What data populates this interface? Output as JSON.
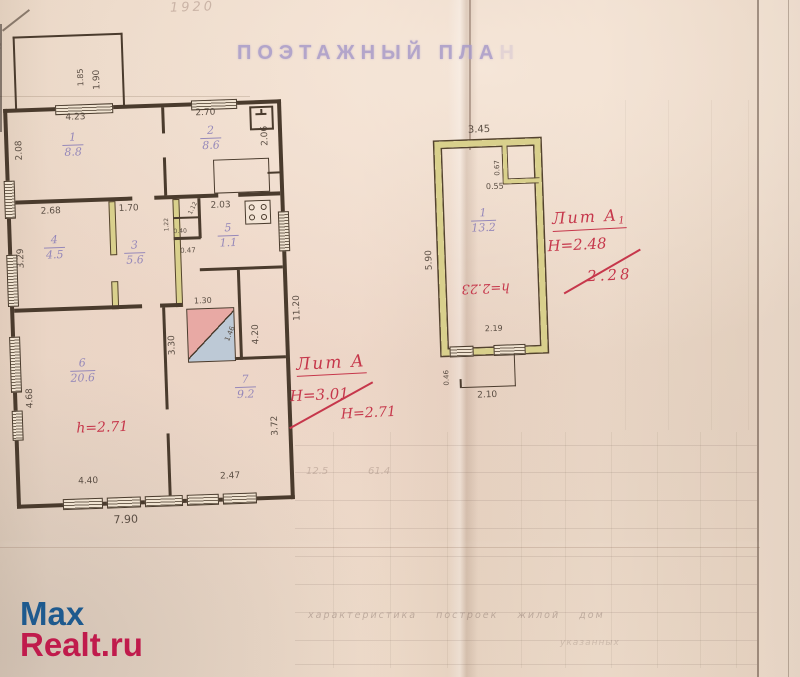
{
  "page": {
    "title_stamp": "ПОЭТАЖНЫЙ ПЛА",
    "title_faint": "Н",
    "year_note": "1920",
    "corner_mark": "40"
  },
  "watermark": {
    "line1": "Max",
    "line2": "Realt.ru"
  },
  "colors": {
    "paper": "#e8d5c4",
    "ink": "#4a3b2d",
    "room_label_purple": "#8d80b8",
    "stamp_purple": "#a89bc9",
    "annotation_red": "#c6374b",
    "wall_highlight_yellow": "#d9d08c",
    "stove_pink": "#e8a9a4",
    "stove_blue": "#bdc9d6",
    "watermark_blue": "#1e5a8e",
    "watermark_red": "#c01b4c"
  },
  "left_building": {
    "height_note": "h=2.71",
    "rooms": [
      {
        "n": "1",
        "a": "8.8",
        "x": 58,
        "y": 24
      },
      {
        "n": "2",
        "a": "8.6",
        "x": 196,
        "y": 22
      },
      {
        "n": "3",
        "a": "5.6",
        "x": 116,
        "y": 134
      },
      {
        "n": "4",
        "a": "4.5",
        "x": 36,
        "y": 126
      },
      {
        "n": "5",
        "a": "1.1",
        "x": 210,
        "y": 120
      },
      {
        "n": "6",
        "a": "20.6",
        "x": 58,
        "y": 250
      },
      {
        "n": "7",
        "a": "9.2",
        "x": 222,
        "y": 272
      }
    ],
    "dims": [
      {
        "t": "1.85",
        "x": 74,
        "y": -20,
        "r": -90,
        "f": 8
      },
      {
        "t": "1.90",
        "x": 90,
        "y": -16,
        "r": -90,
        "f": 9
      },
      {
        "t": "4.23",
        "x": 62,
        "y": 6,
        "f": 9
      },
      {
        "t": "2.70",
        "x": 192,
        "y": 6,
        "f": 9
      },
      {
        "t": "2.06",
        "x": 256,
        "y": 46,
        "r": -90,
        "f": 9
      },
      {
        "t": "2.08",
        "x": 10,
        "y": 52,
        "r": -90,
        "f": 9
      },
      {
        "t": "2.68",
        "x": 34,
        "y": 99,
        "f": 9
      },
      {
        "t": "1.70",
        "x": 112,
        "y": 99,
        "f": 9
      },
      {
        "t": "2.03",
        "x": 204,
        "y": 99,
        "f": 9
      },
      {
        "t": "3.29",
        "x": 8,
        "y": 160,
        "r": -90,
        "f": 9
      },
      {
        "t": "1.22",
        "x": 156,
        "y": 128,
        "r": -90,
        "f": 6
      },
      {
        "t": "1.12",
        "x": 180,
        "y": 110,
        "r": -62,
        "f": 6
      },
      {
        "t": "0.40",
        "x": 166,
        "y": 125,
        "f": 6
      },
      {
        "t": "0.47",
        "x": 172,
        "y": 144,
        "f": 7
      },
      {
        "t": "1.30",
        "x": 184,
        "y": 194,
        "f": 8
      },
      {
        "t": "1.46",
        "x": 212,
        "y": 238,
        "r": -65,
        "f": 7
      },
      {
        "t": "3.30",
        "x": 156,
        "y": 252,
        "r": -90,
        "f": 9
      },
      {
        "t": "4.20",
        "x": 240,
        "y": 244,
        "r": -90,
        "f": 9
      },
      {
        "t": "4.68",
        "x": 12,
        "y": 300,
        "r": -90,
        "f": 9
      },
      {
        "t": "4.40",
        "x": 62,
        "y": 370,
        "f": 9
      },
      {
        "t": "2.47",
        "x": 204,
        "y": 370,
        "f": 9
      },
      {
        "t": "3.72",
        "x": 256,
        "y": 336,
        "r": -90,
        "f": 9
      },
      {
        "t": "7.90",
        "x": 96,
        "y": 408,
        "f": 11
      },
      {
        "t": "11.20",
        "x": 282,
        "y": 222,
        "r": -90,
        "f": 9
      }
    ]
  },
  "right_building": {
    "height_note": "h=2.23",
    "rooms": [
      {
        "n": "1",
        "a": "13.2",
        "x": 34,
        "y": 66
      }
    ],
    "dims": [
      {
        "t": "3.45",
        "x": 34,
        "y": -16,
        "f": 10
      },
      {
        "t": "0.67",
        "x": 58,
        "y": 36,
        "r": -90,
        "f": 7
      },
      {
        "t": "0.55",
        "x": 50,
        "y": 42,
        "f": 8
      },
      {
        "t": "5.90",
        "x": -14,
        "y": 128,
        "r": -90,
        "f": 9
      },
      {
        "t": "2.19",
        "x": 44,
        "y": 184,
        "f": 8
      },
      {
        "t": "0.46",
        "x": 0,
        "y": 244,
        "r": -90,
        "f": 7
      },
      {
        "t": "2.10",
        "x": 34,
        "y": 250,
        "f": 9
      }
    ]
  },
  "annotations": {
    "lit_a": {
      "label": "Лит А",
      "h1": "Н=3.01",
      "h2": "Н=2.71"
    },
    "lit_a1": {
      "label": "Лит А",
      "sub": "1",
      "h1": "Н=2.48",
      "h2": "2.28"
    }
  },
  "bleedthrough": {
    "caption": "характеристика построек жилой дом",
    "caption2": "указанных",
    "num1": "12.5",
    "num2": "61.4"
  }
}
